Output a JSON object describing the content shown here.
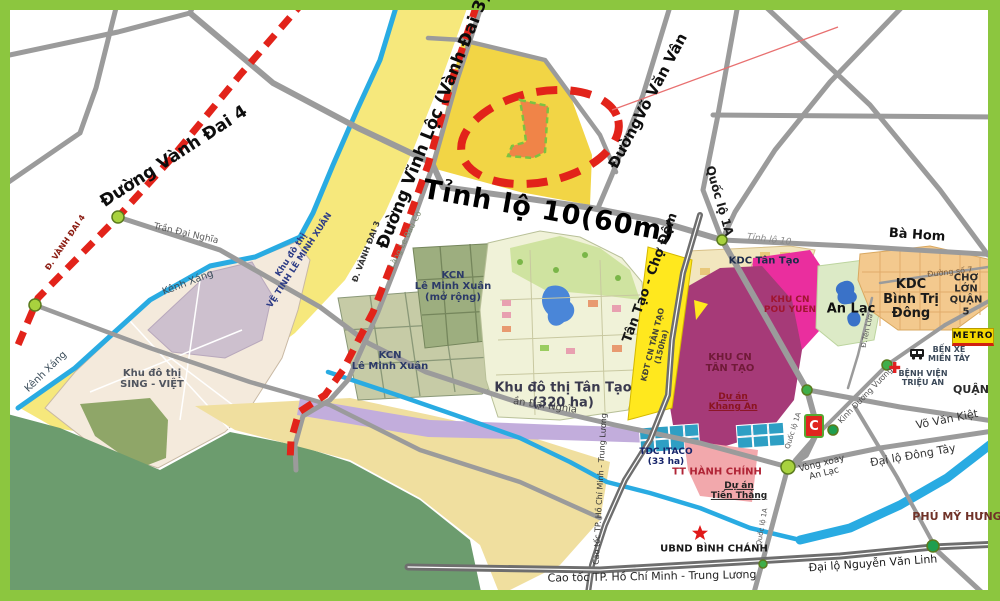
{
  "map": {
    "labels": {
      "duong_vanh_dai_4": "Đường Vành Đai 4",
      "d_vanh_dai_4": "Đ. VÀNH ĐAI 4",
      "duong_vinh_loc_vd3": "Đường Vĩnh Lộc (Vành Đai 3)",
      "d_vanh_dai_3": "Đ. VÀNH ĐAI 3",
      "lang_le_bau_co": "Làng Le Bàu Cò",
      "tinh_lo_10_60m": "Tỉnh lộ 10(60m)",
      "duong_vo_van_van": "ĐườngVõ Văn Vân",
      "quoc_lo_1a_top": "Quốc lộ 1A",
      "quoc_lo_1a_mid": "Quốc lộ 1A",
      "quoc_lo_1a_south": "Quốc lộ 1A",
      "tinh_lo_10_small": "Tỉnh lộ 10",
      "ba_hom": "Bà Hom",
      "kenh_xang_1": "Kênh Xáng",
      "kenh_xang_2": "Kênh Xáng",
      "tran_dai_nghia": "Trần Đại Nghĩa",
      "an_dai_nghia": "ần Đại Nghĩa",
      "khu_do_thi_ve_tinh": "Khu đô thị\nVỆ TINH LÊ MINH XUÂN",
      "sing_viet": "Khu đô thị\nSING - VIỆT",
      "kcn_le_minh_xuan": "KCN\nLê Minh Xuân",
      "kcn_le_minh_xuan_mr": "KCN\nLê Minh Xuân\n(mở rộng)",
      "kdt_tan_tao_320": "Khu đô thị Tân Tạo\n(320 ha)",
      "tan_tao_cho_dem": "Tân Tạo - Chợ Đệm",
      "kdt_cn_tan_tao": "KĐT CN TÂN TẠO\n(150ha)",
      "kdc_tan_tao": "KDC Tân Tạo",
      "khu_cn_pou_yuen": "KHU CN\nPOU YUEN",
      "an_lac": "An Lạc",
      "kdc_binh_tri_dong": "KDC\nBình Trị Đông",
      "duong_so_7": "Đường số 7",
      "cho_lon_quan_5": "CHỢ LỚN\nQUẬN 5",
      "metro": "METRO",
      "ben_xe_mien_tay": "BẾN XE\nMIỀN TÂY",
      "benh_vien_trieu_an": "BỆNH VIỆN\nTRIỆU AN",
      "quan": "QUẬN",
      "khu_cn_tan_tao": "KHU CN\nTÂN TẠO",
      "du_an_khang_an": "Dự án\nKhang An",
      "tdc_itaco": "TDC ITACO\n(33 ha)",
      "tt_hanh_chinh": "TT HÀNH CHÍNH",
      "du_an_tien_thang": "Dự án\nTiền Thắng",
      "ubnd_binh_chanh": "UBND BÌNH CHÁNH",
      "cao_toc_h": "Cao tốc TP. Hồ Chí Minh - Trung Lương",
      "cao_toc_v": "Cao tốc TP. Hồ Chí Minh - Trung Lương",
      "vong_xoay_an_lac": "Vòng xoay\nAn Lạc",
      "kinh_duong_vuong": "Kinh Dương Vương",
      "d_ten_lua": "Đ.Tên Lửa",
      "vo_van_kiet": "Võ Văn Kiệt",
      "dai_lo_dong_tay": "Đại lộ Đông Tây",
      "phu_my_hung": "PHÚ MỸ HƯNG",
      "dai_lo_nguyen_van_linh": "Đại lộ Nguyễn Văn Linh",
      "big_c": "C"
    },
    "palette": {
      "frame_green": "#8CC63F",
      "water_blue": "#29ABE2",
      "road_gray": "#9B9B9B",
      "highway_gray": "#6E6E6E",
      "ring_road_red_dashed": "#E2231A",
      "project_yellow": "#F2D545",
      "project_site_orange": "#F08448",
      "site_border_green_dashed": "#7CC242",
      "corridor_yellow": "#F6E87C",
      "pale_yellow_band": "#F0DF9F",
      "kdt_cn_strip_yellow": "#FFE81E",
      "dark_green_area": "#6C9C6E",
      "lavender_strip": "#C2ADDC",
      "pou_yuen_magenta": "#EA2E9E",
      "tan_tao_ip_maroon": "#A63A78",
      "tt_hanh_chinh_pink": "#F2A8AC",
      "tdc_itaco_teal": "#2E9FC4",
      "sing_viet_beige": "#F4EADC",
      "kdc_btd_orange": "#F3C98E",
      "node_green": "#A8D23E"
    }
  }
}
